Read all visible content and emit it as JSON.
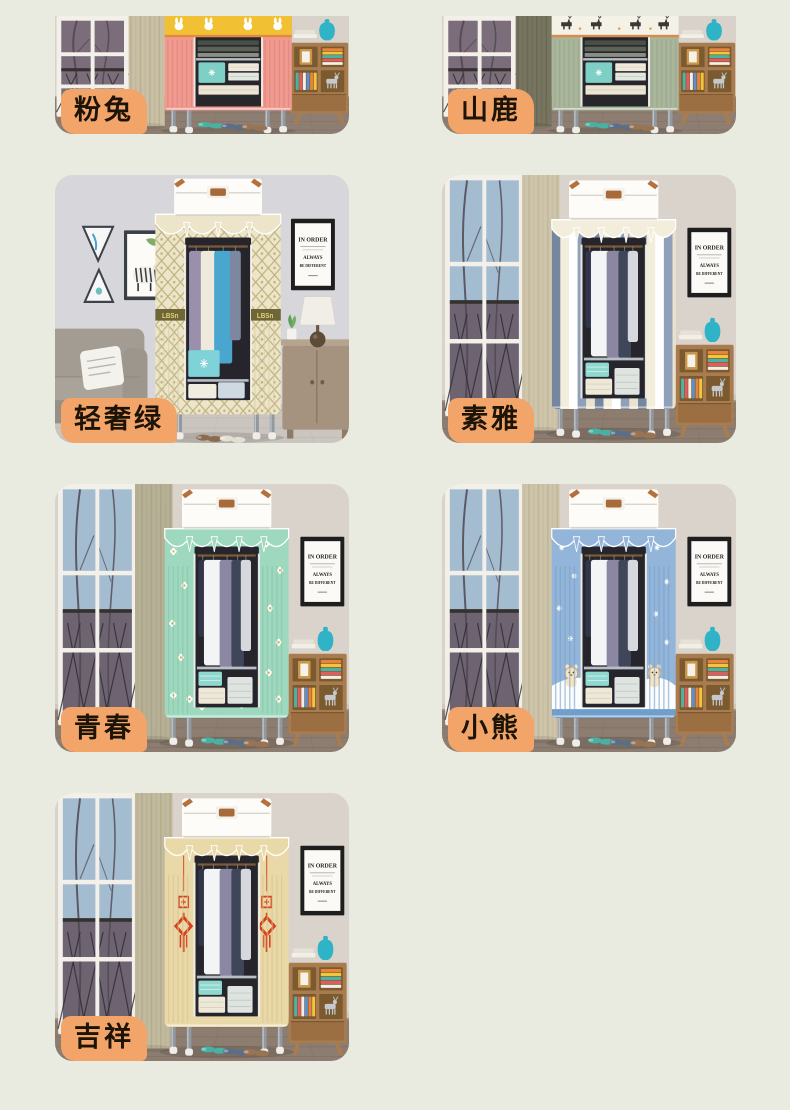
{
  "page": {
    "background_color": "#e9ebe0",
    "badge_color": "#f3a469",
    "badge_text_color": "#1d1408",
    "description": "product variant gallery of fabric wardrobes"
  },
  "poster": {
    "line1": "IN ORDER",
    "line2": "ALWAYS",
    "line3": "BE DIFFERENT"
  },
  "products": [
    {
      "label": "粉兔",
      "scene": "cropped",
      "variant": "pink-rabbit",
      "c": {
        "band": "#f1c033",
        "bandFig": "#ffffff",
        "bandLine": "#e08a3c",
        "fabric": "#f19a90",
        "pleat": "#dd8379",
        "curtain": "#c8bfa4",
        "curtainDark": "#b0a689"
      }
    },
    {
      "label": "山鹿",
      "scene": "cropped",
      "variant": "mountain-deer",
      "c": {
        "band": "#f4f1e7",
        "bandFig": "#3a3a35",
        "bandLine": "#d98b4a",
        "fabric": "#a9b69b",
        "pleat": "#96a488",
        "curtain": "#77755f",
        "curtainDark": "#61604a"
      }
    },
    {
      "label": "轻奢绿",
      "scene": "living",
      "variant": "luxury-green-lattice",
      "c": {
        "fabric": "#ece5c9",
        "pleat": "#d6cda6",
        "lattice": "#b3a468",
        "band": "#6e6636",
        "bandText": "#e4cf7a"
      }
    },
    {
      "label": "素雅",
      "scene": "window",
      "variant": "stripes",
      "c": {
        "fabric": "#f3eedc",
        "pleat": "#d9d2bc",
        "curtain": "#cec5ab",
        "curtainDark": "#b8ae92",
        "stripes": [
          "#75869f",
          "#f3eedc",
          "#ffffff",
          "#8fa0b8",
          "#e8e2cf"
        ]
      }
    },
    {
      "label": "青春",
      "scene": "window",
      "variant": "mint-floral",
      "c": {
        "fabric": "#9ed8bf",
        "pleat": "#89c5aa",
        "curtain": "#b6b096",
        "curtainDark": "#a29b7e",
        "flower": "#ffffff",
        "flowerCenter": "#e9a23b"
      }
    },
    {
      "label": "小熊",
      "scene": "window",
      "variant": "bear-snow",
      "c": {
        "fabric": "#92b5d9",
        "pleat": "#7da2c7",
        "curtain": "#cdc4aa",
        "curtainDark": "#b5ab8d",
        "hill": "#ffffff",
        "hillBase": "#6f9ecb",
        "bear": "#f6e4c1"
      }
    },
    {
      "label": "吉祥",
      "scene": "window",
      "variant": "china-knot",
      "c": {
        "fabric": "#ead9a8",
        "pleat": "#d6c48d",
        "curtain": "#c2ba9e",
        "curtainDark": "#aba182",
        "motif": "#d7401e"
      }
    }
  ]
}
